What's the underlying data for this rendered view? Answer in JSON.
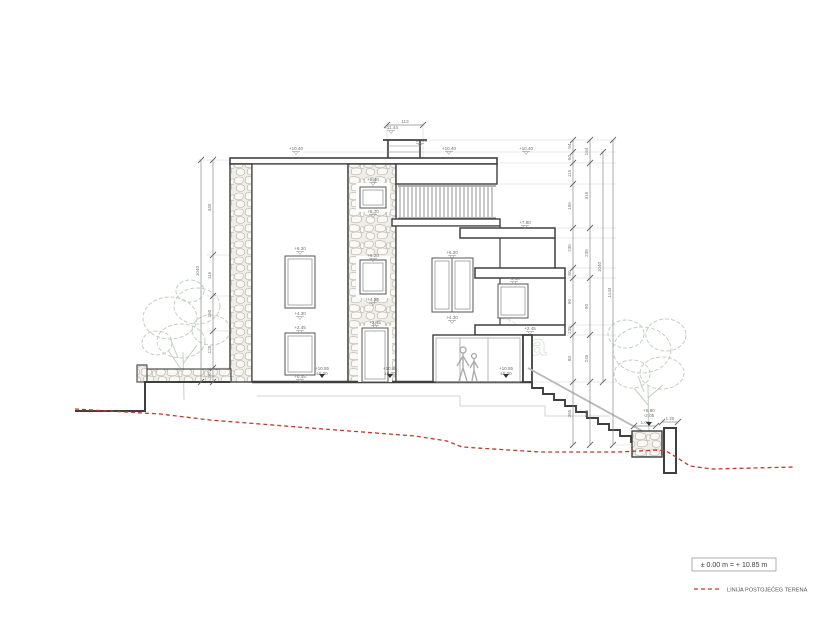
{
  "title": "architectural-section-elevation",
  "legend": {
    "datum_box": "± 0.00 m = + 10.85 m",
    "terrain_label": "LINIJA POSTOJEĆEG TERENA"
  },
  "watermark": "burza nekretnina",
  "colors": {
    "outline": "#3f3f3f",
    "dimension": "#8a8a8a",
    "terrain_line": "#c0392b",
    "tree": "#b9c6b9",
    "stone": "#b6b0a6"
  },
  "dims": {
    "top": {
      "y": 125,
      "nodes": [
        387,
        423
      ],
      "labels": [
        "113"
      ]
    },
    "left": [
      {
        "x": 201,
        "nodes": [
          160,
          382
        ],
        "labels": [
          "1040"
        ]
      },
      {
        "x": 213,
        "nodes": [
          160,
          255,
          296,
          331,
          368,
          382
        ],
        "labels": [
          "440",
          "115",
          "150",
          "125",
          "80"
        ]
      }
    ],
    "right": [
      {
        "x": 573,
        "nodes": [
          140,
          152,
          163,
          184,
          228,
          268,
          278,
          325,
          335,
          382,
          445
        ],
        "labels": [
          "54",
          "50",
          "115",
          "155",
          "235",
          "80",
          "90",
          "235",
          "80",
          "365"
        ]
      },
      {
        "x": 590,
        "nodes": [
          140,
          163,
          228,
          278,
          335,
          382,
          445
        ],
        "labels": [
          "164",
          "315",
          "235",
          "90",
          "245",
          "365"
        ]
      },
      {
        "x": 603,
        "nodes": [
          152,
          382
        ],
        "labels": [
          "1040"
        ]
      },
      {
        "x": 613,
        "nodes": [
          140,
          445
        ],
        "labels": [
          "1144"
        ]
      }
    ],
    "small": [
      {
        "y": 426,
        "nodes": [
          634,
          656
        ],
        "labels": [
          "1.00"
        ]
      },
      {
        "y": 422,
        "nodes": [
          662,
          678
        ],
        "labels": [
          "1.25"
        ]
      }
    ]
  },
  "levels": [
    {
      "label": "+11.44",
      "x": 391,
      "y": 129
    },
    {
      "label": "+10.90",
      "x": 420,
      "y": 142
    },
    {
      "label": "+10.40",
      "x": 296,
      "y": 150
    },
    {
      "label": "+10.40",
      "x": 449,
      "y": 150
    },
    {
      "label": "+10.40",
      "x": 526,
      "y": 150
    },
    {
      "label": "+9.40",
      "x": 373,
      "y": 181
    },
    {
      "label": "+8.70",
      "x": 373,
      "y": 213
    },
    {
      "label": "+6.20",
      "x": 300,
      "y": 250
    },
    {
      "label": "+4.30",
      "x": 300,
      "y": 315
    },
    {
      "label": "+6.20",
      "x": 373,
      "y": 257
    },
    {
      "label": "+4.30",
      "x": 373,
      "y": 301
    },
    {
      "label": "+6.20",
      "x": 452,
      "y": 254
    },
    {
      "label": "+4.30",
      "x": 452,
      "y": 319
    },
    {
      "label": "+5.10",
      "x": 514,
      "y": 280
    },
    {
      "label": "+2.45",
      "x": 300,
      "y": 329
    },
    {
      "label": "+0.45",
      "x": 300,
      "y": 378
    },
    {
      "label": "+2.45",
      "x": 375,
      "y": 324
    },
    {
      "label": "+2.45",
      "x": 530,
      "y": 330
    },
    {
      "label": "+7.80",
      "x": 525,
      "y": 224
    }
  ],
  "floor_markers": [
    {
      "top": "+10.85",
      "bottom": "±0.00",
      "x": 322,
      "y": 370,
      "ty": 378
    },
    {
      "top": "+10.85",
      "bottom": "±0.00",
      "x": 390,
      "y": 370,
      "ty": 378
    },
    {
      "top": "+10.85",
      "bottom": "±0.00",
      "x": 506,
      "y": 370,
      "ty": 378
    },
    {
      "top": "+8.80",
      "bottom": "-2.05",
      "x": 649,
      "y": 412,
      "ty": 426
    }
  ]
}
